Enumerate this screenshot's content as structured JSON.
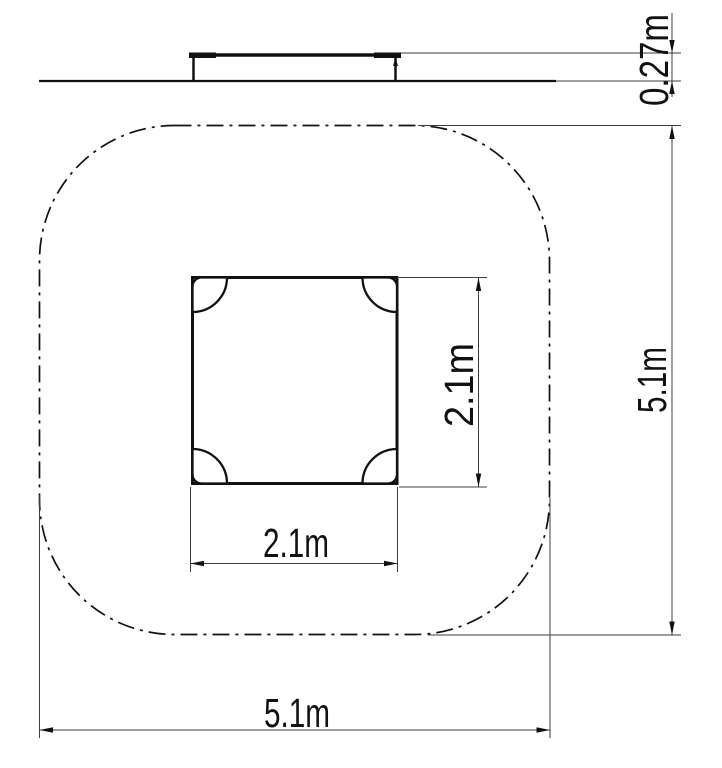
{
  "drawing": {
    "background_color": "#ffffff",
    "line_color": "#111111",
    "elevation": {
      "description": "side elevation of platform on ground line",
      "height_dim": {
        "label": "0.27m"
      }
    },
    "plan": {
      "description": "plan view of square platform inside rounded safety zone",
      "equipment_width_dim": {
        "label": "2.1m"
      },
      "equipment_depth_dim": {
        "label": "2.1m"
      },
      "safety_zone_width_dim": {
        "label": "5.1m"
      },
      "safety_zone_depth_dim": {
        "label": "5.1m"
      }
    }
  }
}
